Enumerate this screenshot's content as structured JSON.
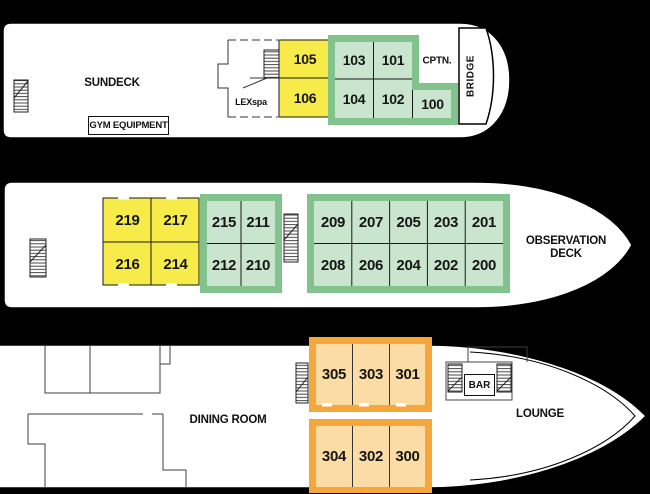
{
  "title": "Ship deck plan",
  "colors": {
    "background": "#000000",
    "hull": "#ffffff",
    "yellow_cabin": "#f7eb4a",
    "green_border": "#82c38d",
    "green_cabin": "#c9e5ce",
    "orange_border": "#f5a73b",
    "orange_cabin": "#fbdca4",
    "line": "#1a1a1a"
  },
  "decks": [
    {
      "labels": {
        "deck_name": "SUNDECK",
        "gym": "GYM EQUIPMENT",
        "spa": "LEXspa",
        "captain": "CPTN.",
        "bridge": "BRIDGE"
      },
      "cabins": {
        "yellow": [
          "105",
          "106"
        ],
        "green": [
          "103",
          "101",
          "104",
          "102",
          "100"
        ]
      }
    },
    {
      "labels": {
        "deck_name": "OBSERVATION DECK"
      },
      "cabins": {
        "yellow": [
          "219",
          "217",
          "216",
          "214"
        ],
        "green_fwd": [
          "215",
          "211",
          "212",
          "210"
        ],
        "green_aft": [
          "209",
          "207",
          "205",
          "203",
          "201",
          "208",
          "206",
          "204",
          "202",
          "200"
        ]
      }
    },
    {
      "labels": {
        "dining": "DINING ROOM",
        "lounge": "LOUNGE",
        "bar": "BAR"
      },
      "cabins": {
        "orange_upper": [
          "305",
          "303",
          "301"
        ],
        "orange_lower": [
          "304",
          "302",
          "300"
        ]
      }
    }
  ]
}
